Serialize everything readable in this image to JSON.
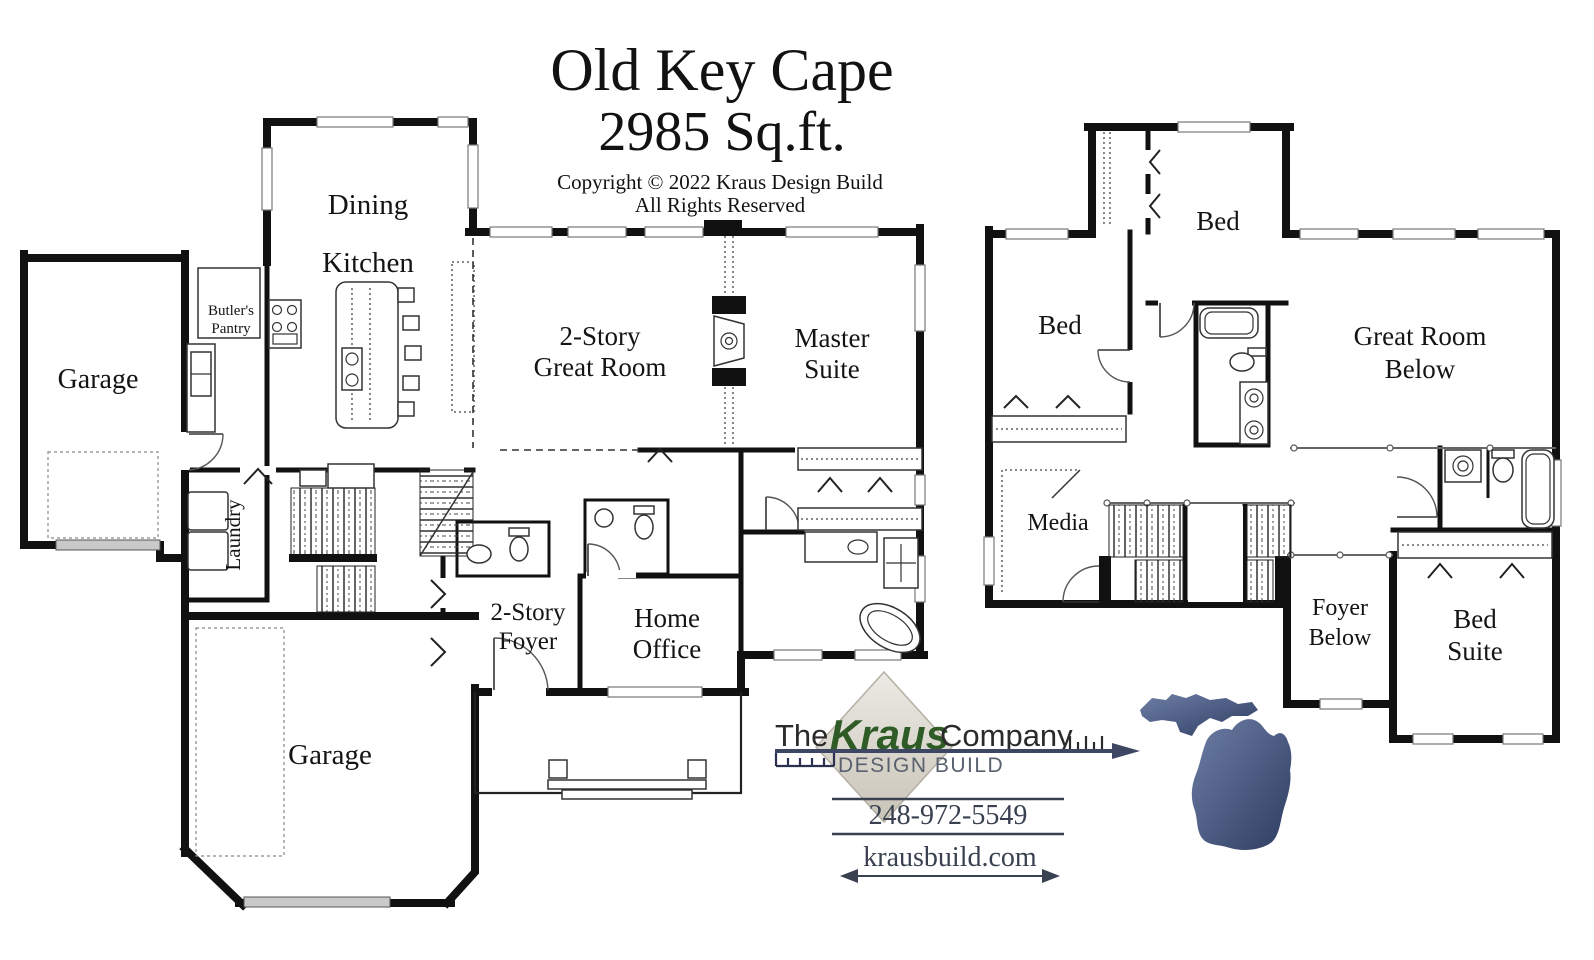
{
  "header": {
    "plan_name": "Old Key Cape",
    "square_footage": "2985 Sq.ft.",
    "copyright_line1": "Copyright © 2022 Kraus Design Build",
    "copyright_line2": "All Rights Reserved"
  },
  "first_floor": {
    "garage_left": "Garage",
    "dining": "Dining",
    "kitchen": "Kitchen",
    "butlers_pantry_line1": "Butler's",
    "butlers_pantry_line2": "Pantry",
    "great_room_line1": "2-Story",
    "great_room_line2": "Great Room",
    "master_suite_line1": "Master",
    "master_suite_line2": "Suite",
    "laundry": "Laundry",
    "foyer_line1": "2-Story",
    "foyer_line2": "Foyer",
    "home_office_line1": "Home",
    "home_office_line2": "Office",
    "garage_bottom": "Garage"
  },
  "second_floor": {
    "bed_top": "Bed",
    "bed_left": "Bed",
    "great_room_below_line1": "Great Room",
    "great_room_below_line2": "Below",
    "media": "Media",
    "foyer_below_line1": "Foyer",
    "foyer_below_line2": "Below",
    "bed_suite_line1": "Bed",
    "bed_suite_line2": "Suite"
  },
  "branding": {
    "the": "The",
    "kraus": "Kraus",
    "company": "Company",
    "design_build": "DESIGN BUILD",
    "phone": "248-972-5549",
    "website": "krausbuild.com",
    "colors": {
      "kraus_green": "#2e5b26",
      "line_navy": "#3d4663",
      "diamond_beige": "#d8d4ca",
      "michigan_blue": "#44557f",
      "text_slate": "#39404f"
    }
  }
}
